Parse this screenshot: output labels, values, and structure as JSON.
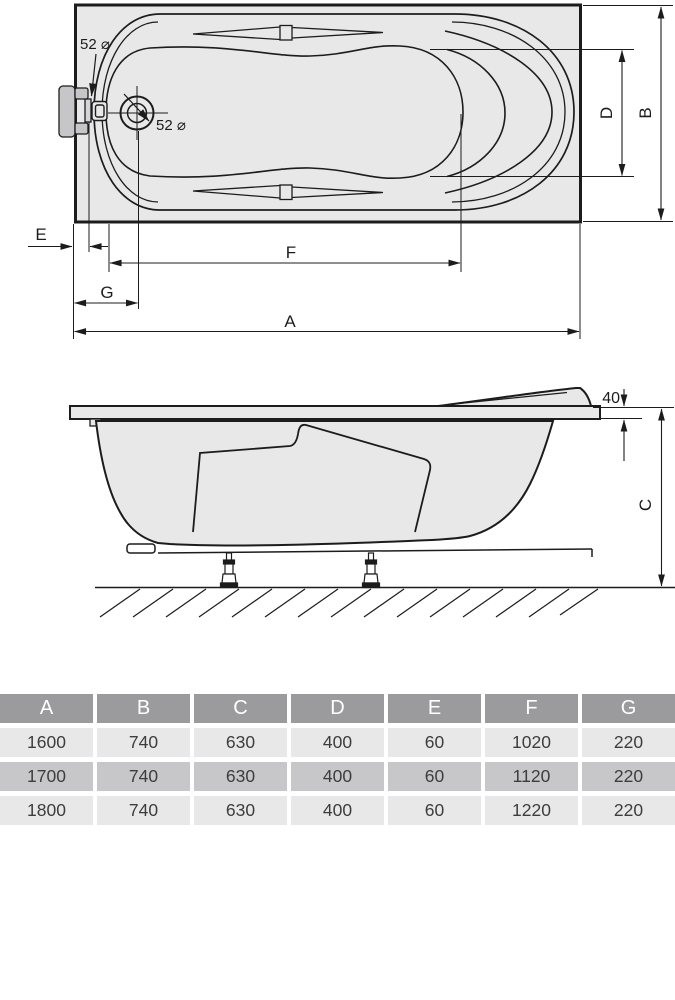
{
  "plan_view": {
    "overflow_diameter_label": "52 ⌀",
    "drain_diameter_label": "52 ⌀",
    "dim_e": "E",
    "dim_f": "F",
    "dim_g": "G",
    "dim_a": "A",
    "dim_d": "D",
    "dim_b": "B"
  },
  "side_view": {
    "rim_thickness_label": "40",
    "dim_c": "C"
  },
  "table": {
    "headers": [
      "A",
      "B",
      "C",
      "D",
      "E",
      "F",
      "G"
    ],
    "rows": [
      [
        "1600",
        "740",
        "630",
        "400",
        "60",
        "1020",
        "220"
      ],
      [
        "1700",
        "740",
        "630",
        "400",
        "60",
        "1120",
        "220"
      ],
      [
        "1800",
        "740",
        "630",
        "400",
        "60",
        "1220",
        "220"
      ]
    ]
  },
  "colors": {
    "line": "#1c1c1c",
    "tub_fill": "#e8e8e8",
    "fitting_fill": "#c6c6c8",
    "table_header_bg": "#9b9b9d",
    "table_row_light": "#e8e8e8",
    "table_row_mid": "#c7c7c9",
    "table_text": "#3d3d3f"
  }
}
